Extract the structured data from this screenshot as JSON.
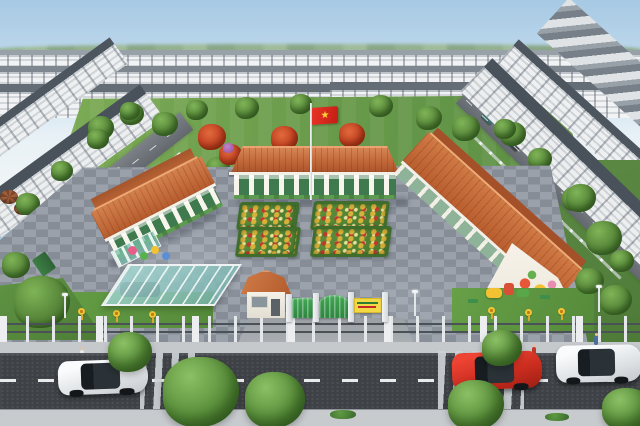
{
  "meta": {
    "title": "Aerial 3D rendering of a kindergarten campus inside a townhouse residential development",
    "image_type": "3D architectural render",
    "view": "high-angle aerial, looking across a main road toward the school"
  },
  "palette": {
    "sky_top": "#a7c9e3",
    "sky_bottom": "#f4f6f7",
    "lawn_green": "#6fa04f",
    "tile_roof_orange": "#c4683a",
    "school_wall_white": "#f6f3ec",
    "school_trim_green": "#3f7a4e",
    "paver_gray": "#8f96a0",
    "asphalt": "#3e4246",
    "crosswalk_white": "#ccd2d6",
    "fence_white": "#e5e8ea",
    "gate_green": "#3a9d4e",
    "sign_yellow": "#f3d945",
    "flag_red": "#da251d",
    "flag_star_yellow": "#ffd633",
    "townhouse_roof_gray": "#4a535b",
    "townhouse_wall_white": "#f1f2f3",
    "flame_tree_red": "#c03e20",
    "canopy_teal": "#8fc9c4"
  },
  "scene": {
    "flag": {
      "description": "Vietnamese flag (red with yellow star) on white pole at center of rear lawn",
      "star_char": "★"
    },
    "school": {
      "building_count": 3,
      "roof_style": "orange terracotta tile, hipped and gabled single-storey blocks",
      "features": [
        "colonnaded verandas with green doors",
        "children's mural on right building gable end",
        "playground slides and equipment",
        "teal translucent drop-off canopy with dark car beneath",
        "four ornamental flower beds in central paved courtyard",
        "white perimeter fence with posts and pillars"
      ]
    },
    "entrance": {
      "gatehouse": "white guard house with orange hip roof and window",
      "gates": "green metal side gate and arched main gate between white pillars",
      "sign": {
        "color": "yellow board with green and red lettering",
        "legible": false
      }
    },
    "surroundings": {
      "housing": "continuous rows of white 3-storey townhouses with dark gray pitched roofs on all sides",
      "streets": "tree-lined internal streets flanking the school with small parked cars",
      "lawn": "large green field with red-flowering flame trees behind the school",
      "market_umbrellas": "brown shop umbrellas at far left street"
    },
    "foreground": {
      "road": {
        "lanes": 2,
        "marking": "dashed white centerline",
        "crosswalks": 2
      },
      "vehicles": [
        {
          "color": "white",
          "position": "left lane heading left"
        },
        {
          "color": "red",
          "position": "right of center"
        },
        {
          "color": "white",
          "position": "far right edge"
        }
      ],
      "pedestrians": 4,
      "sidewalks": "light gray, both sides, with large street trees and small hedges"
    }
  }
}
